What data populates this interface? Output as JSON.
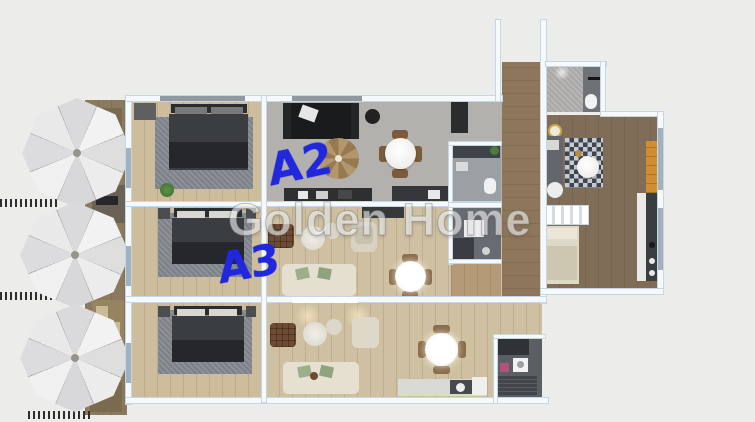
{
  "scene": {
    "type": "3d-floor-plan-render",
    "background_color": "#ececeb",
    "apartments_marked": [
      "A2",
      "A3"
    ]
  },
  "watermark": {
    "text": "Golden Home",
    "color": "rgba(253,253,253,0.58)"
  },
  "annotations": [
    {
      "label": "A2",
      "color": "#2127dd"
    },
    {
      "label": "A3",
      "color": "#2127dd"
    }
  ],
  "palette": {
    "wall_fill": "#f5f9fc",
    "wall_border": "#c6d7e3",
    "light_wood_floor": "#cfc0a1",
    "bedroom_wood_floor": "#cdbd9c",
    "dark_wood_floor": "#7f6d57",
    "corridor_wood": "#8d7659",
    "concrete_floor": "#b2b1ad",
    "rug_gray": "#848991",
    "bed_dark": "#3b3e41",
    "sofa_black": "#191b1d",
    "sofa_cream": "#e4dfcf",
    "pillow_green": "#9cae8a",
    "accent_orange": "#d18d2f",
    "bathroom_gray": "#676c72",
    "umbrella_white": "#e9e9ea",
    "ink_blue": "#2127dd"
  }
}
